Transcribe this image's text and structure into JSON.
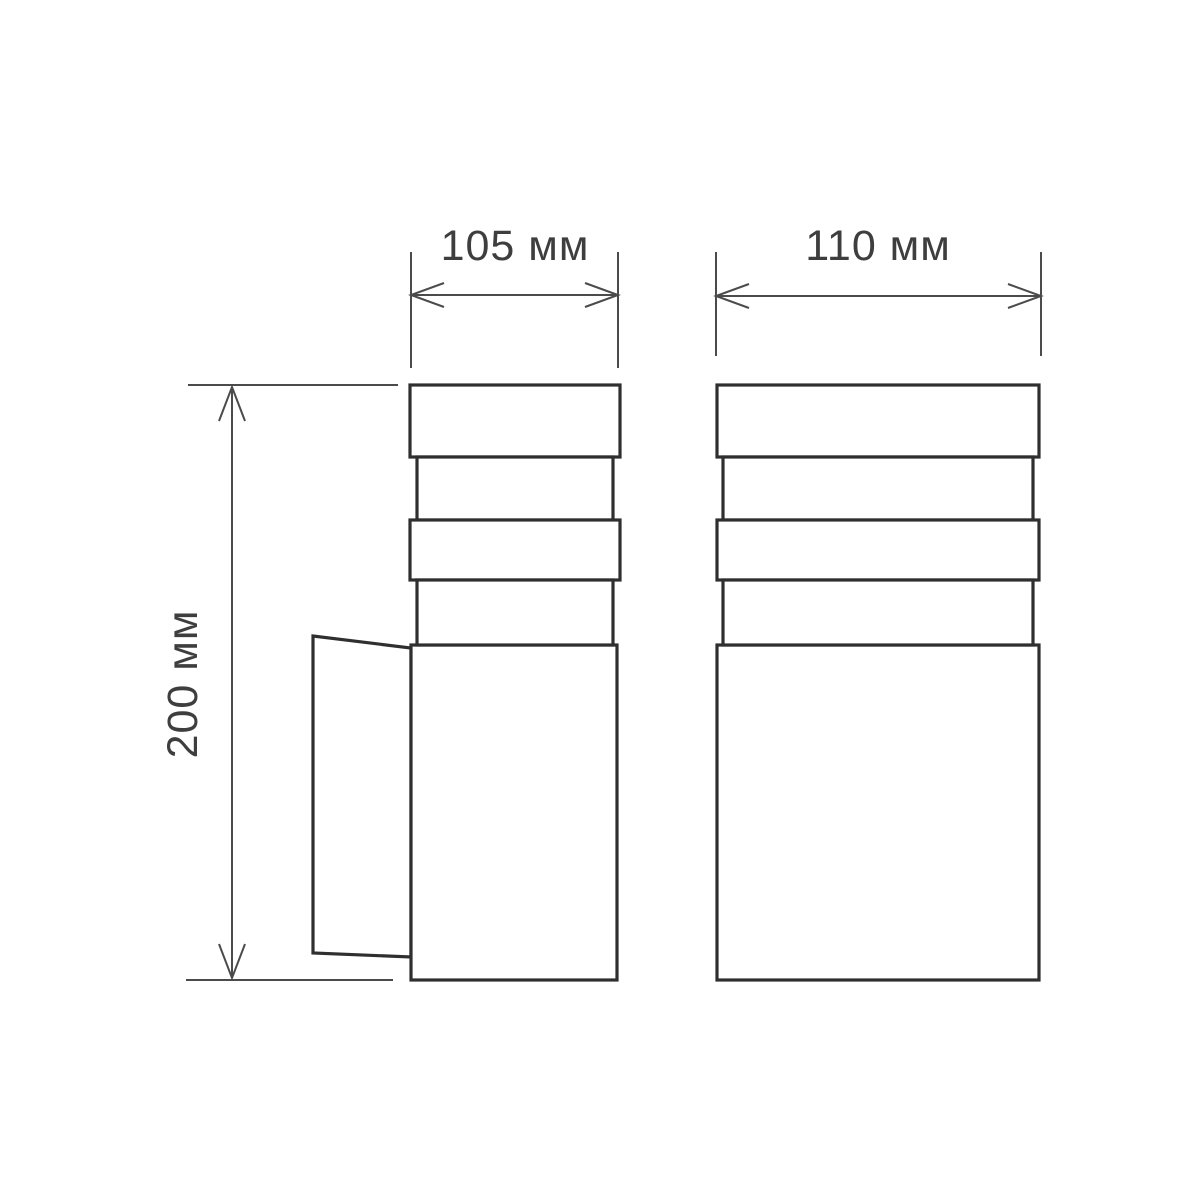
{
  "page": {
    "title": "Luminaire dimensional drawing",
    "background_color": "#ffffff"
  },
  "colors": {
    "object_line": "#2f2f2f",
    "dimension_line": "#4b4b4b",
    "label_text": "#3e3e3e"
  },
  "views": {
    "side_view_name": "side-view-with-wall-bracket",
    "front_view_name": "front-view"
  },
  "dimensions": {
    "side_width": {
      "label": "105 мм",
      "value": 105,
      "unit": "мм",
      "orientation": "horizontal"
    },
    "front_width": {
      "label": "110 мм",
      "value": 110,
      "unit": "мм",
      "orientation": "horizontal"
    },
    "height": {
      "label": "200 мм",
      "value": 200,
      "unit": "мм",
      "orientation": "vertical"
    }
  }
}
